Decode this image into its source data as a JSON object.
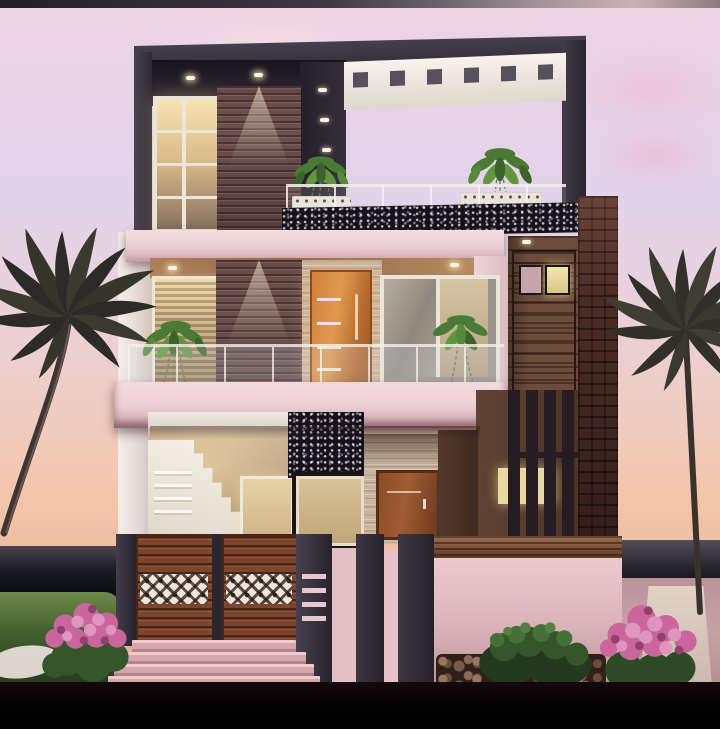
{
  "meta": {
    "type": "3d-architectural-render",
    "subject": "Modern three-storey house front elevation at sunset with palm trees",
    "time_of_day": "dusk",
    "no_visible_text": true
  },
  "palette": {
    "letterbox": "#060406",
    "sky_top": "#ecd4e0",
    "sky_lavender": "#e2d3ea",
    "sky_peach": "#f3c6ab",
    "horizon_dark": "#1a1a22",
    "roof_frame": "#39333e",
    "pergola_white": "#f5f1ea",
    "granite_speckle": "#15121a",
    "slab_pink": "#f0d6da",
    "wood_slat_wall": "#7a5c57",
    "ceiling_wood": "#a37a58",
    "travertine": "#c8b5a0",
    "orange_door": "#cf7f3c",
    "brown_door": "#8a4c2a",
    "tower_wood": "#6e4c3c",
    "dark_service_door": "#3d2a24",
    "brick_pier": "#502f28",
    "louver_dark": "#261d22",
    "interior_beige": "#cfb899",
    "staircase_white": "#f5f0e7",
    "gate_wood": "#7c452c",
    "gate_post": "#37323c",
    "lattice_cream": "#efe7da",
    "compound_wall_pink": "#e2bfc3",
    "wall_coping_wood": "#7c4e34",
    "steps_pink": "#d8a9ad",
    "lawn_green": "#4e6b38",
    "shrub_green": "#3c5c2d",
    "flower_pink": "#cc6fa2",
    "palm_silhouette": "#32302c",
    "warm_light": "#ffe9c4"
  },
  "scene": {
    "background": {
      "sky": "Sunset gradient sky, pink to lavender to peach",
      "clouds": "Soft pink cloud smudges in upper right sky",
      "horizon_left": "Dark sea horizon band at lower left",
      "horizon_right": "Dark sea horizon band at lower right"
    },
    "house": {
      "top_floor": {
        "roof": "Dark angular roof frame",
        "pergola": "White cantilevered pergola slab with dark skylight slots",
        "window": "Tall warm-lit casement window with 2x4 panes",
        "accent_wall": "Mauve wood-slat wall washed by a downlight",
        "back_wall": "Dark wall with recessed wall-washer lights",
        "terrace": "Glass-railed terrace with two potted plants in white planters",
        "parapet": "Black speckled granite parapet band"
      },
      "second_floor": {
        "slab": "Pink projecting balcony slabs above and below",
        "window_left": "Lit louvered bedroom window",
        "accent_wall": "Mauve wood-slat wall with downlight",
        "door": "Orange flush door with bar handle and travertine surround",
        "window_right": "Grey aluminium sliding window",
        "plants": "Green balcony plants left and right",
        "railing": "Frameless glass balcony railing"
      },
      "right_tower": {
        "bay": "Dark timber panelled bay",
        "door": "Dark service door with two small fanlights, one lit",
        "louvers": "Vertical timber louver screen with lit window behind",
        "pier": "Rustic clay brick pier"
      },
      "ground_floor": {
        "staircase": "White staircase seen through open front",
        "walls": "Warm beige foyer walls",
        "interior_door": "Lit beige interior door",
        "column": "Black speckled granite feature column",
        "stone_wall": "Travertine wall panel",
        "door": "Brown panelled ground-floor door"
      }
    },
    "frontage": {
      "gate": "Double timber-slat gate with perforated cream lattice band",
      "posts": "Dark grey gate piers, right pier with pink slit vents",
      "wall": "Pink compound wall with timber coping",
      "steps": "Four wide pink entry steps",
      "pebbles": "Pebble border along the compound wall"
    },
    "landscape": {
      "palm_left": "Curved palm tree silhouette on the left",
      "palm_right": "Tall palm tree silhouette on the right",
      "lawn": "Green lawn with a white stepping stone",
      "shrub_flower_left": "Pink flowering shrub on the lawn",
      "shrub_green": "Green shrub beside the wall",
      "shrub_flower_right": "Large pink flowering shrub at the right"
    }
  }
}
